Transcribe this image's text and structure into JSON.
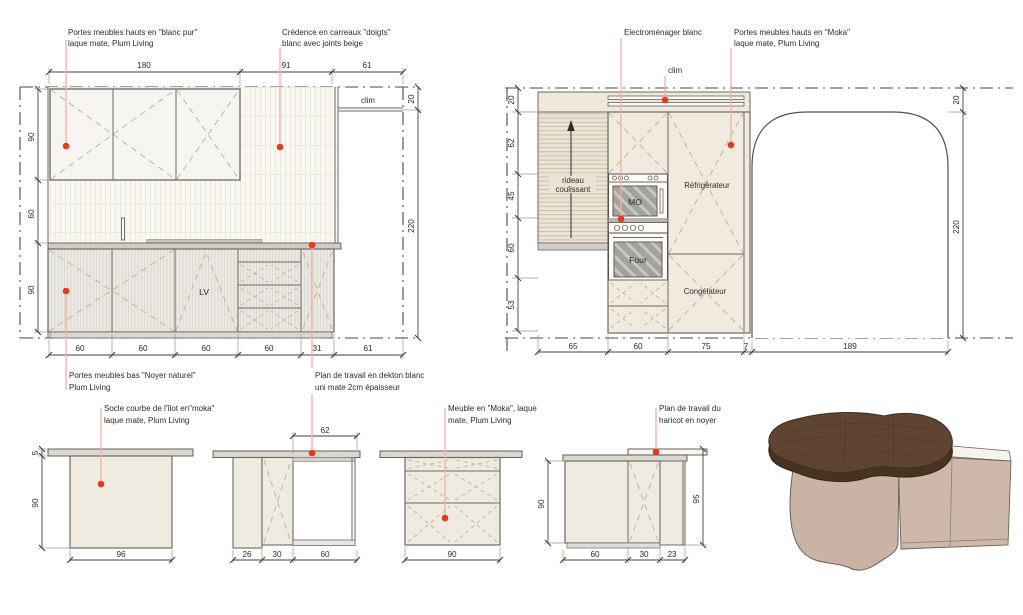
{
  "colors": {
    "accent_dot": "#e8391c",
    "leader_line": "#f4b1a6",
    "cabinet_beige": "#f1eadf",
    "base_grey": "#ebe9e4",
    "walnut": "#5f4531",
    "taupe_island": "#c9b3a4"
  },
  "left_elevation": {
    "dims": {
      "top": [
        "180",
        "91",
        "61"
      ],
      "left": [
        "90",
        "60",
        "90"
      ],
      "right": [
        "20",
        "220"
      ],
      "bottom": [
        "60",
        "60",
        "60",
        "60",
        "31",
        "61"
      ]
    },
    "labels": {
      "clim": "clim",
      "lv": "LV"
    },
    "callouts": {
      "upper_white": [
        "Portes meubles hauts en \"blanc pur\"",
        "laque mate, Plum Living"
      ],
      "credence": [
        "Crédence en carreaux \"doigts\"",
        "blanc avec joints beige"
      ],
      "lower_walnut": [
        "Portes meubles bas \"Noyer naturel\"",
        "Plum Living"
      ],
      "worktop_dekton": [
        "Plan de travail en dekton blanc",
        "uni mate 2cm épaisseur"
      ]
    }
  },
  "right_elevation": {
    "dims": {
      "left": [
        "20",
        "62",
        "45",
        "60",
        "53"
      ],
      "right": [
        "20",
        "220"
      ],
      "bottom": [
        "65",
        "60",
        "75",
        "7",
        "189"
      ]
    },
    "labels": {
      "clim": "clim",
      "rideau": [
        "rideau",
        "coulissant"
      ],
      "fridge": "Réfrigérateur",
      "freezer": "Congélateur",
      "micro": "MO",
      "oven": "Four"
    },
    "callouts": {
      "appliances": [
        "Electroménager blanc"
      ],
      "upper_moka": [
        "Portes meubles hauts en \"Moka\"",
        "laque mate, Plum Living"
      ]
    }
  },
  "islands": {
    "i1": {
      "dims": {
        "left": [
          "5",
          "90"
        ],
        "bottom": [
          "96"
        ]
      },
      "callout": [
        "Socle courbe de l'îlot en\"moka\"",
        "laque mate, Plum Living"
      ]
    },
    "i2": {
      "dims": {
        "top": [
          "62"
        ],
        "bottom": [
          "26",
          "30",
          "60"
        ]
      }
    },
    "i3": {
      "dims": {
        "bottom": [
          "90"
        ]
      },
      "callout": [
        "Meuble en \"Moka\", laque",
        "mate, Plum Living"
      ]
    },
    "i4": {
      "dims": {
        "left": [
          "90"
        ],
        "right": [
          "95"
        ],
        "bottom": [
          "60",
          "30",
          "23"
        ]
      },
      "callout": [
        "Plan de travail du",
        "haricot en noyer"
      ]
    }
  }
}
